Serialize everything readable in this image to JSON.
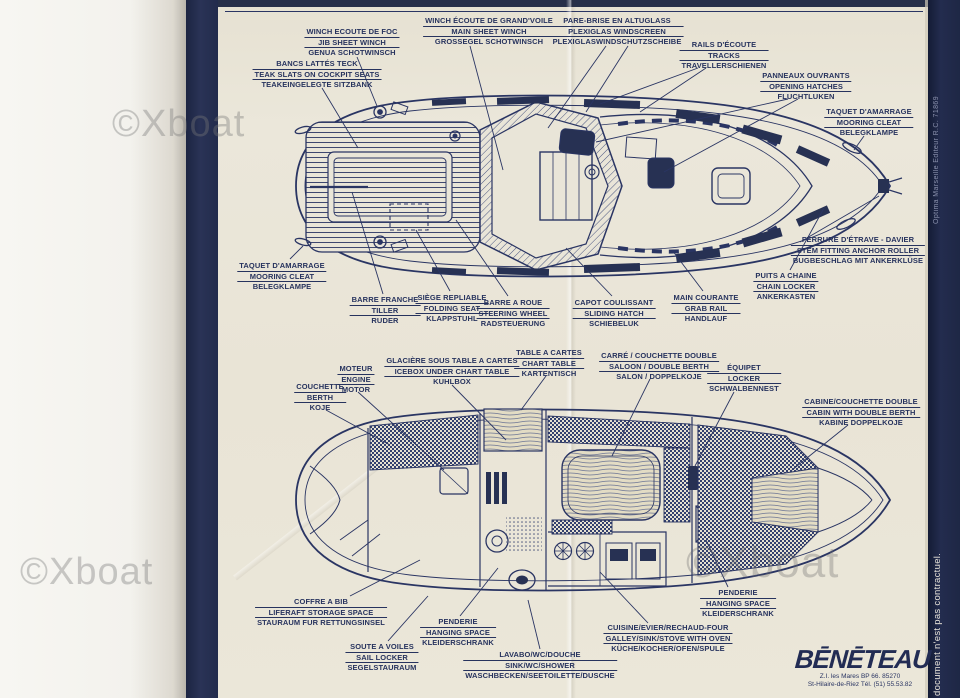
{
  "watermark": {
    "text": "©Xboat"
  },
  "margin_texts": {
    "publisher_vertical": "Optima Marseille Editeur R.C. 71869",
    "disclaimer_vertical": "document n'est pas contractuel."
  },
  "brand": {
    "logo": "BĒNĒTEAU",
    "address_line1": "Z.I. les Mares BP 66. 85270",
    "address_line2": "St-Hilaire-de-Riez Tél. (51) 55.53.82"
  },
  "deck_plan": {
    "labels": [
      {
        "id": "winch_foc",
        "lines": [
          "WINCH ECOUTE DE FOC",
          "JIB SHEET WINCH",
          "GENUA SCHOTWINSCH"
        ]
      },
      {
        "id": "winch_gv",
        "lines": [
          "WINCH ÉCOUTE DE GRAND'VOILE",
          "MAIN SHEET WINCH",
          "GROSSEGEL SCHOTWINSCH"
        ]
      },
      {
        "id": "pare_brise",
        "lines": [
          "PARE-BRISE EN ALTUGLASS",
          "PLEXIGLAS WINDSCREEN",
          "PLEXIGLASWINDSCHUTZSCHEIBE"
        ]
      },
      {
        "id": "rails_ecoute",
        "lines": [
          "RAILS D'ÉCOUTE",
          "TRACKS",
          "TRAVELLERSCHIENEN"
        ]
      },
      {
        "id": "panneaux",
        "lines": [
          "PANNEAUX OUVRANTS",
          "OPENING HATCHES",
          "FLUCHTLUKEN"
        ]
      },
      {
        "id": "taquet_tribord",
        "lines": [
          "TAQUET D'AMARRAGE",
          "MOORING CLEAT",
          "BELEGKLAMPE"
        ]
      },
      {
        "id": "bancs_teck",
        "lines": [
          "BANCS LATTÉS TECK",
          "TEAK SLATS ON COCKPIT SEATS",
          "TEAKEINGELEGTE SITZBANK"
        ]
      },
      {
        "id": "taquet_babord",
        "lines": [
          "TAQUET D'AMARRAGE",
          "MOORING CLEAT",
          "BELEGKLAMPE"
        ]
      },
      {
        "id": "barre_franche",
        "lines": [
          "BARRE FRANCHE",
          "TILLER",
          "RUDER"
        ]
      },
      {
        "id": "siege_repliable",
        "lines": [
          "SIÈGE REPLIABLE",
          "FOLDING SEAT",
          "KLAPPSTUHL"
        ]
      },
      {
        "id": "barre_a_roue",
        "lines": [
          "BARRE A ROUE",
          "STEERING WHEEL",
          "RADSTEUERUNG"
        ]
      },
      {
        "id": "capot_coulissant",
        "lines": [
          "CAPOT COULISSANT",
          "SLIDING HATCH",
          "SCHIEBELUK"
        ]
      },
      {
        "id": "main_courante",
        "lines": [
          "MAIN COURANTE",
          "GRAB RAIL",
          "HANDLAUF"
        ]
      },
      {
        "id": "ferrure_etrave",
        "lines": [
          "FERRURE D'ÉTRAVE - DAVIER",
          "STEM FITTING ANCHOR ROLLER",
          "BUGBESCHLAG MIT ANKERKLÜSE"
        ]
      },
      {
        "id": "puits_chaine",
        "lines": [
          "PUITS A CHAINE",
          "CHAIN LOCKER",
          "ANKERKASTEN"
        ]
      }
    ]
  },
  "interior_plan": {
    "labels": [
      {
        "id": "moteur",
        "lines": [
          "MOTEUR",
          "ENGINE",
          "MOTOR"
        ]
      },
      {
        "id": "glaciere",
        "lines": [
          "GLACIÈRE SOUS TABLE A CARTES",
          "ICEBOX UNDER CHART TABLE",
          "KUHLBOX"
        ]
      },
      {
        "id": "table_a_cartes",
        "lines": [
          "TABLE A CARTES",
          "CHART TABLE",
          "KARTENTISCH"
        ]
      },
      {
        "id": "carre",
        "lines": [
          "CARRÉ / COUCHETTE DOUBLE",
          "SALOON / DOUBLE BERTH",
          "SALON / DOPPELKOJE"
        ]
      },
      {
        "id": "equipet",
        "lines": [
          "ÉQUIPET",
          "LOCKER",
          "SCHWALBENNEST"
        ]
      },
      {
        "id": "couchette",
        "lines": [
          "COUCHETTE",
          "BERTH",
          "KOJE"
        ]
      },
      {
        "id": "cabine_double",
        "lines": [
          "CABINE/COUCHETTE DOUBLE",
          "CABIN WITH DOUBLE BERTH",
          "KABINE DOPPELKOJE"
        ]
      },
      {
        "id": "coffre_a_bib",
        "lines": [
          "COFFRE A BIB",
          "LIFERAFT STORAGE SPACE",
          "STAURAUM FUR RETTUNGSINSEL"
        ]
      },
      {
        "id": "penderie_milieu",
        "lines": [
          "PENDERIE",
          "HANGING SPACE",
          "KLEIDERSCHRANK"
        ]
      },
      {
        "id": "soute_a_voiles",
        "lines": [
          "SOUTE A VOILES",
          "SAIL LOCKER",
          "SEGELSTAURAUM"
        ]
      },
      {
        "id": "lavabo_wc",
        "lines": [
          "LAVABO/WC/DOUCHE",
          "SINK/WC/SHOWER",
          "WASCHBECKEN/SEETOILETTE/DUSCHE"
        ]
      },
      {
        "id": "cuisine",
        "lines": [
          "CUISINE/EVIER/RECHAUD-FOUR",
          "GALLEY/SINK/STOVE WITH OVEN",
          "KÜCHE/KOCHER/OFEN/SPULE"
        ]
      },
      {
        "id": "penderie_avant",
        "lines": [
          "PENDERIE",
          "HANGING SPACE",
          "KLEIDERSCHRANK"
        ]
      }
    ]
  }
}
